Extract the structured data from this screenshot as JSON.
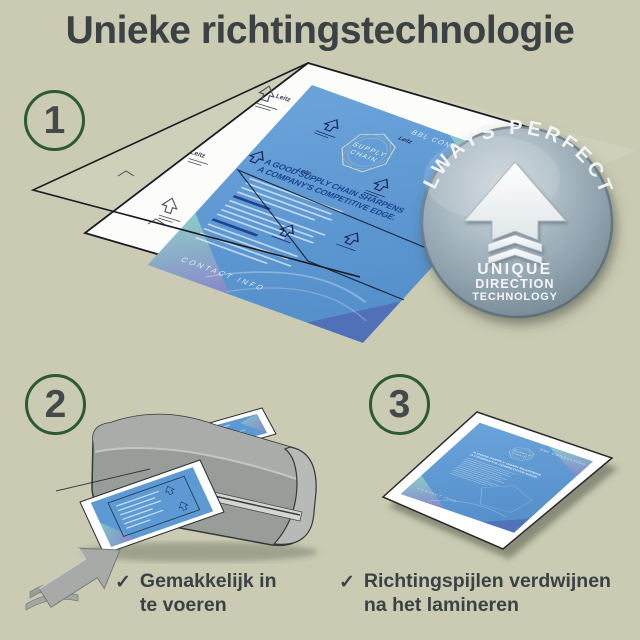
{
  "title": "Unieke richtingstechnologie",
  "steps": {
    "step1": {
      "number": "1"
    },
    "step2": {
      "number": "2",
      "caption_line1": "Gemakkelijk in",
      "caption_line2": "te voeren"
    },
    "step3": {
      "number": "3",
      "caption_line1": "Richtingspijlen verdwijnen",
      "caption_line2": "na het lamineren"
    }
  },
  "check_glyph": "✓",
  "badge": {
    "arc_text": "ALWAYS PERFECT!",
    "line1": "UNIQUE",
    "line2": "DIRECTION",
    "line3": "TECHNOLOGY"
  },
  "document": {
    "brand": "BBL CONSULTING",
    "logo_word1": "SUPPLY",
    "logo_word2": "CHAIN",
    "headline_line1": "A GOOD SUPPLY CHAIN SHARPENS",
    "headline_line2": "A COMPANY'S COMPETITIVE EDGE.",
    "footer": "CONTACT INFO",
    "pouch_brand": "Leitz"
  },
  "colors": {
    "background": "#cacbb2",
    "text_dark": "#3b4245",
    "circle_green": "#2b5a33",
    "document_blue": "#5c98d1",
    "headline_navy": "#1c4392",
    "badge_steel": "#8fa2ae",
    "laminator_gray": "#999d9a",
    "corner_teal": "#8fd0c8",
    "corner_purple": "#8b84c9"
  }
}
